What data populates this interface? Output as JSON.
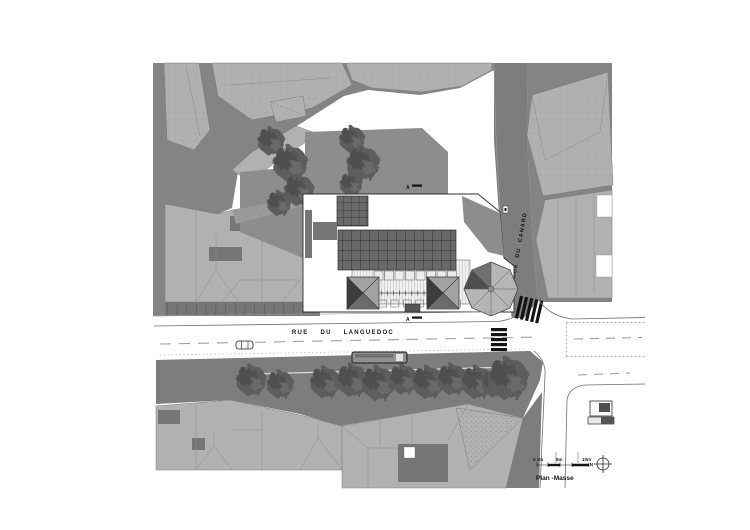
{
  "plan": {
    "title": "Plan -Masse",
    "streets": {
      "languedoc_label": "RUE DU LANGUEDOC",
      "canard_label": "RUE DU CANARD"
    },
    "section_markers": {
      "top": "A",
      "bottom": "A"
    },
    "scale_bar": {
      "zero_label": "0 1m",
      "five_label": "5m",
      "ten_label": "10m",
      "north_label": "N"
    },
    "colors": {
      "paper": "#ffffff",
      "ground": "#848484",
      "ground2": "#8d8d8d",
      "street": "#7d7d7d",
      "roof-light": "#b1b1b1",
      "roof-dark": "#767676",
      "tree": "#5d5d5d",
      "tree-dark": "#454545",
      "glass-cell": "#696969",
      "glass-line": "#2e2e2e",
      "ink": "#141414",
      "road-line": "#a0a0a0"
    }
  }
}
